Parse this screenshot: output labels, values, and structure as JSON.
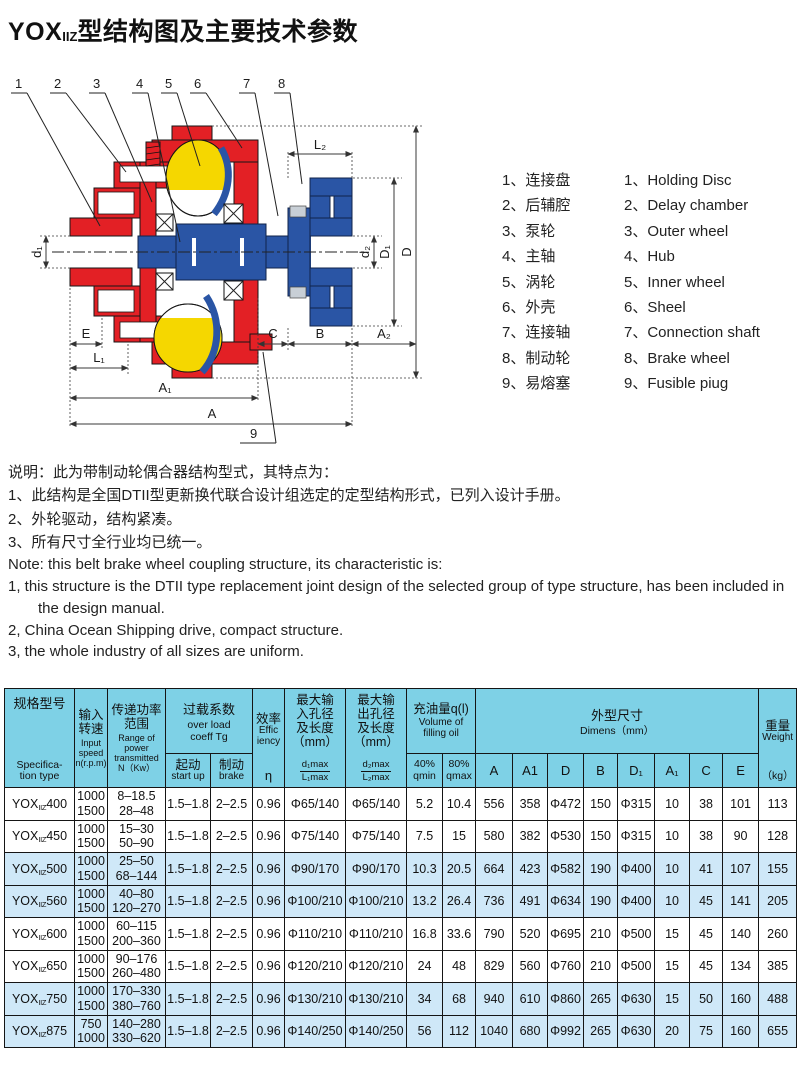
{
  "colors": {
    "red": "#e32025",
    "yellow": "#f5d700",
    "blue": "#2a55a5",
    "hdr": "#7ed1e6",
    "hl": "#cfe8f8"
  },
  "title": {
    "prefix": "YOX",
    "sub": "IIZ",
    "rest": "型结构图及主要技术参数"
  },
  "diagram": {
    "callouts": [
      "1",
      "2",
      "3",
      "4",
      "5",
      "6",
      "7",
      "8",
      "9"
    ],
    "dims": {
      "d1": "d₁",
      "L2": "L₂",
      "d2": "d₂",
      "D1": "D₁",
      "D": "D",
      "E": "E",
      "L1": "L₁",
      "A1": "A₁",
      "A": "A",
      "C": "C",
      "B": "B",
      "A2": "A₂"
    }
  },
  "legend": {
    "items": [
      {
        "num": "1",
        "zh": "连接盘",
        "en": "Holding Disc"
      },
      {
        "num": "2",
        "zh": "后辅腔",
        "en": "Delay chamber"
      },
      {
        "num": "3",
        "zh": "泵轮",
        "en": "Outer wheel"
      },
      {
        "num": "4",
        "zh": "主轴",
        "en": "Hub"
      },
      {
        "num": "5",
        "zh": "涡轮",
        "en": "Inner wheel"
      },
      {
        "num": "6",
        "zh": "外壳",
        "en": "Sheel"
      },
      {
        "num": "7",
        "zh": "连接轴",
        "en": "Connection shaft"
      },
      {
        "num": "8",
        "zh": "制动轮",
        "en": "Brake wheel"
      },
      {
        "num": "9",
        "zh": "易熔塞",
        "en": "Fusible piug"
      }
    ]
  },
  "notes_zh": [
    "说明：此为带制动轮偶合器结构型式，其特点为：",
    "1、此结构是全国DTII型更新换代联合设计组选定的定型结构形式，已列入设计手册。",
    "2、外轮驱动，结构紧凑。",
    "3、所有尺寸全行业均已统一。"
  ],
  "notes_en": [
    "Note: this belt brake wheel coupling structure, its characteristic is:",
    "1, this structure is the DTII type replacement joint design of the selected group of type structure, has been included in the design manual.",
    "2, China Ocean Shipping drive, compact structure.",
    "3, the whole industry of all sizes are uniform."
  ],
  "table": {
    "header": {
      "spec_zh": "规格型号",
      "spec_en": "Specifica-\ntion type",
      "speed_zh": "输入\n转速",
      "speed_en": "Input\nspeed\nn(r.p.m)",
      "power_zh": "传递功率\n范围",
      "power_en": "Range of\npower\ntransmitted\nN（Kw）",
      "overload_zh": "过载系数",
      "overload_en": "over load\ncoeff  Tg",
      "start_zh": "起动",
      "start_en": "start up",
      "brake_zh": "制动",
      "brake_en": "brake",
      "eff_zh": "效率",
      "eff_en": "Effic\niency",
      "eff_sym": "η",
      "din_zh": "最大输\n入孔径\n及长度\n（mm）",
      "din_top": "d₁max",
      "din_bot": "L₁max",
      "dout_zh": "最大输\n出孔径\n及长度\n（mm）",
      "dout_top": "d₂max",
      "dout_bot": "L₂max",
      "oil_zh": "充油量q(l)",
      "oil_en": "Volume of\nfilling oil",
      "oil40": "40%\nqmin",
      "oil80": "80%\nqmax",
      "dim_zh": "外型尺寸",
      "dim_en": "Dimens（mm）",
      "dims": [
        "A",
        "A1",
        "D",
        "B",
        "D₁",
        "A₁",
        "C",
        "E"
      ],
      "weight_zh": "重量",
      "weight_en": "Weight",
      "weight_unit": "（kg）"
    },
    "rows": [
      {
        "model": {
          "prefix": "YOX",
          "sub": "IIZ",
          "size": "400"
        },
        "highlight": false,
        "cells": [
          [
            "1000",
            "1500"
          ],
          [
            "8–18.5",
            "28–48"
          ],
          "1.5–1.8",
          "2–2.5",
          "0.96",
          "Φ65/140",
          "Φ65/140",
          "5.2",
          "10.4",
          "556",
          "358",
          "Φ472",
          "150",
          "Φ315",
          "10",
          "38",
          "101",
          "113"
        ]
      },
      {
        "model": {
          "prefix": "YOX",
          "sub": "IIZ",
          "size": "450"
        },
        "highlight": false,
        "cells": [
          [
            "1000",
            "1500"
          ],
          [
            "15–30",
            "50–90"
          ],
          "1.5–1.8",
          "2–2.5",
          "0.96",
          "Φ75/140",
          "Φ75/140",
          "7.5",
          "15",
          "580",
          "382",
          "Φ530",
          "150",
          "Φ315",
          "10",
          "38",
          "90",
          "128"
        ]
      },
      {
        "model": {
          "prefix": "YOX",
          "sub": "IIZ",
          "size": "500"
        },
        "highlight": true,
        "cells": [
          [
            "1000",
            "1500"
          ],
          [
            "25–50",
            "68–144"
          ],
          "1.5–1.8",
          "2–2.5",
          "0.96",
          "Φ90/170",
          "Φ90/170",
          "10.3",
          "20.5",
          "664",
          "423",
          "Φ582",
          "190",
          "Φ400",
          "10",
          "41",
          "107",
          "155"
        ]
      },
      {
        "model": {
          "prefix": "YOX",
          "sub": "IIZ",
          "size": "560"
        },
        "highlight": true,
        "cells": [
          [
            "1000",
            "1500"
          ],
          [
            "40–80",
            "120–270"
          ],
          "1.5–1.8",
          "2–2.5",
          "0.96",
          "Φ100/210",
          "Φ100/210",
          "13.2",
          "26.4",
          "736",
          "491",
          "Φ634",
          "190",
          "Φ400",
          "10",
          "45",
          "141",
          "205"
        ]
      },
      {
        "model": {
          "prefix": "YOX",
          "sub": "IIZ",
          "size": "600"
        },
        "highlight": false,
        "cells": [
          [
            "1000",
            "1500"
          ],
          [
            "60–115",
            "200–360"
          ],
          "1.5–1.8",
          "2–2.5",
          "0.96",
          "Φ110/210",
          "Φ110/210",
          "16.8",
          "33.6",
          "790",
          "520",
          "Φ695",
          "210",
          "Φ500",
          "15",
          "45",
          "140",
          "260"
        ]
      },
      {
        "model": {
          "prefix": "YOX",
          "sub": "IIZ",
          "size": "650"
        },
        "highlight": false,
        "cells": [
          [
            "1000",
            "1500"
          ],
          [
            "90–176",
            "260–480"
          ],
          "1.5–1.8",
          "2–2.5",
          "0.96",
          "Φ120/210",
          "Φ120/210",
          "24",
          "48",
          "829",
          "560",
          "Φ760",
          "210",
          "Φ500",
          "15",
          "45",
          "134",
          "385"
        ]
      },
      {
        "model": {
          "prefix": "YOX",
          "sub": "IIZ",
          "size": "750"
        },
        "highlight": true,
        "cells": [
          [
            "1000",
            "1500"
          ],
          [
            "170–330",
            "380–760"
          ],
          "1.5–1.8",
          "2–2.5",
          "0.96",
          "Φ130/210",
          "Φ130/210",
          "34",
          "68",
          "940",
          "610",
          "Φ860",
          "265",
          "Φ630",
          "15",
          "50",
          "160",
          "488"
        ]
      },
      {
        "model": {
          "prefix": "YOX",
          "sub": "IIZ",
          "size": "875"
        },
        "highlight": true,
        "cells": [
          [
            "750",
            "1000"
          ],
          [
            "140–280",
            "330–620"
          ],
          "1.5–1.8",
          "2–2.5",
          "0.96",
          "Φ140/250",
          "Φ140/250",
          "56",
          "112",
          "1040",
          "680",
          "Φ992",
          "265",
          "Φ630",
          "20",
          "75",
          "160",
          "655"
        ]
      }
    ]
  }
}
